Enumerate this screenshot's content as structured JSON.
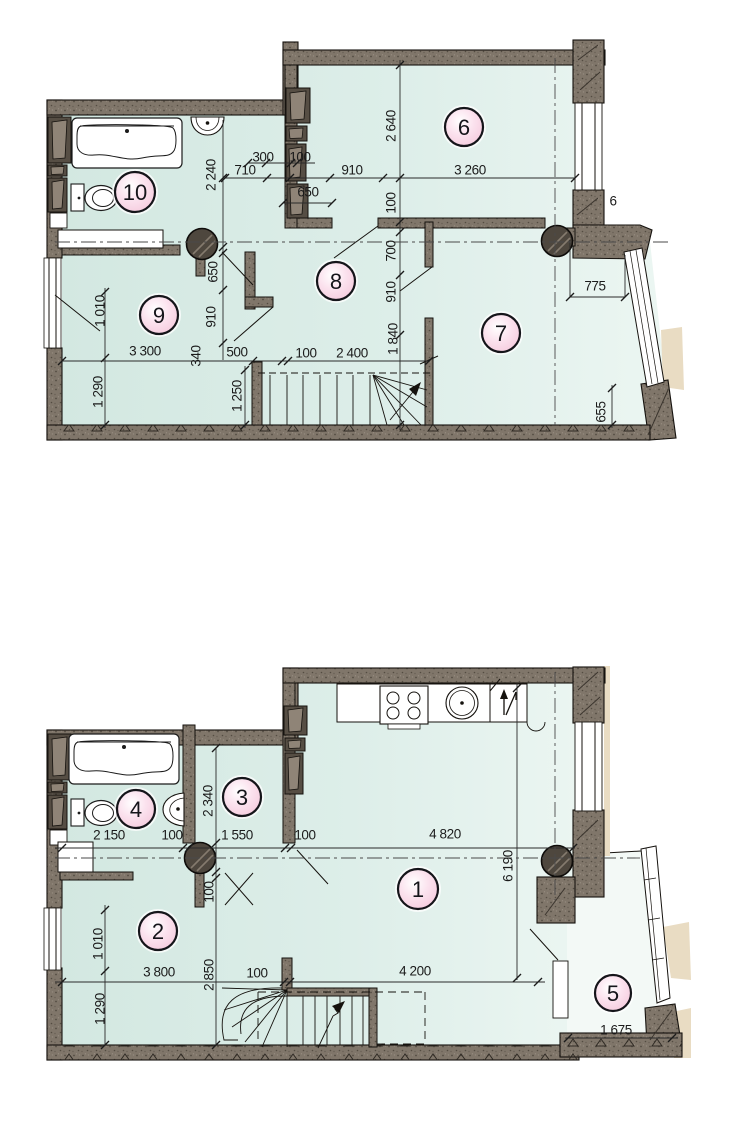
{
  "drawing": {
    "kind_label": "floor-plan",
    "colors": {
      "floor": "#d6eae4",
      "floor_light": "#e9f4f0",
      "balcony_floor": "#f3f9f6",
      "wall": "#7e7366",
      "wall_dark": "#564e44",
      "room_badge_fill": "#f7cfe0",
      "line": "#1b1b1b",
      "exterior_mask": "#e9dcc3"
    },
    "plans": {
      "upper": {
        "rooms": [
          {
            "n": "6",
            "x": 464,
            "y": 127,
            "r": 19
          },
          {
            "n": "7",
            "x": 501,
            "y": 333,
            "r": 19
          },
          {
            "n": "8",
            "x": 336,
            "y": 281,
            "r": 19
          },
          {
            "n": "9",
            "x": 159,
            "y": 315,
            "r": 19
          },
          {
            "n": "10",
            "x": 135,
            "y": 192,
            "r": 20
          }
        ],
        "dims": [
          {
            "t": "2 240",
            "x": 211,
            "y": 175,
            "rot": -90
          },
          {
            "t": "300",
            "x": 263,
            "y": 157
          },
          {
            "t": "100",
            "x": 300,
            "y": 157
          },
          {
            "t": "710",
            "x": 245,
            "y": 170
          },
          {
            "t": "910",
            "x": 352,
            "y": 170
          },
          {
            "t": "3 260",
            "x": 470,
            "y": 170
          },
          {
            "t": "650",
            "x": 308,
            "y": 192
          },
          {
            "t": "2 640",
            "x": 391,
            "y": 126,
            "rot": -90
          },
          {
            "t": "100",
            "x": 391,
            "y": 203,
            "rot": -90
          },
          {
            "t": "700",
            "x": 391,
            "y": 251,
            "rot": -90
          },
          {
            "t": "910",
            "x": 391,
            "y": 292,
            "rot": -90
          },
          {
            "t": "1 840",
            "x": 393,
            "y": 339,
            "rot": -90
          },
          {
            "t": "650",
            "x": 213,
            "y": 272,
            "rot": -90
          },
          {
            "t": "910",
            "x": 211,
            "y": 317,
            "rot": -90
          },
          {
            "t": "1 010",
            "x": 100,
            "y": 311,
            "rot": -90
          },
          {
            "t": "3 300",
            "x": 145,
            "y": 351
          },
          {
            "t": "340",
            "x": 196,
            "y": 356,
            "rot": -90
          },
          {
            "t": "500",
            "x": 237,
            "y": 352
          },
          {
            "t": "100",
            "x": 306,
            "y": 353
          },
          {
            "t": "2 400",
            "x": 352,
            "y": 353
          },
          {
            "t": "1 290",
            "x": 98,
            "y": 392,
            "rot": -90
          },
          {
            "t": "1 250",
            "x": 237,
            "y": 396,
            "rot": -90
          },
          {
            "t": "775",
            "x": 595,
            "y": 286
          },
          {
            "t": "655",
            "x": 601,
            "y": 412,
            "rot": -90
          },
          {
            "t": "6",
            "x": 613,
            "y": 201,
            "size": 11
          }
        ]
      },
      "lower": {
        "rooms": [
          {
            "n": "1",
            "x": 418,
            "y": 889,
            "r": 20
          },
          {
            "n": "2",
            "x": 158,
            "y": 931,
            "r": 19
          },
          {
            "n": "3",
            "x": 242,
            "y": 797,
            "r": 19
          },
          {
            "n": "4",
            "x": 136,
            "y": 809,
            "r": 19
          },
          {
            "n": "5",
            "x": 613,
            "y": 993,
            "r": 18
          }
        ],
        "dims": [
          {
            "t": "2 150",
            "x": 109,
            "y": 835
          },
          {
            "t": "100",
            "x": 172,
            "y": 835
          },
          {
            "t": "1 550",
            "x": 237,
            "y": 835
          },
          {
            "t": "100",
            "x": 305,
            "y": 835
          },
          {
            "t": "4 820",
            "x": 445,
            "y": 834
          },
          {
            "t": "2 340",
            "x": 208,
            "y": 801,
            "rot": -90
          },
          {
            "t": "6 190",
            "x": 508,
            "y": 866,
            "rot": -90
          },
          {
            "t": "100",
            "x": 209,
            "y": 892,
            "rot": -90
          },
          {
            "t": "1 010",
            "x": 98,
            "y": 944,
            "rot": -90
          },
          {
            "t": "1 290",
            "x": 100,
            "y": 1009,
            "rot": -90
          },
          {
            "t": "3 800",
            "x": 159,
            "y": 972
          },
          {
            "t": "2 850",
            "x": 209,
            "y": 975,
            "rot": -90
          },
          {
            "t": "100",
            "x": 257,
            "y": 973
          },
          {
            "t": "4 200",
            "x": 415,
            "y": 971
          },
          {
            "t": "1 675",
            "x": 616,
            "y": 1030
          }
        ]
      }
    }
  }
}
